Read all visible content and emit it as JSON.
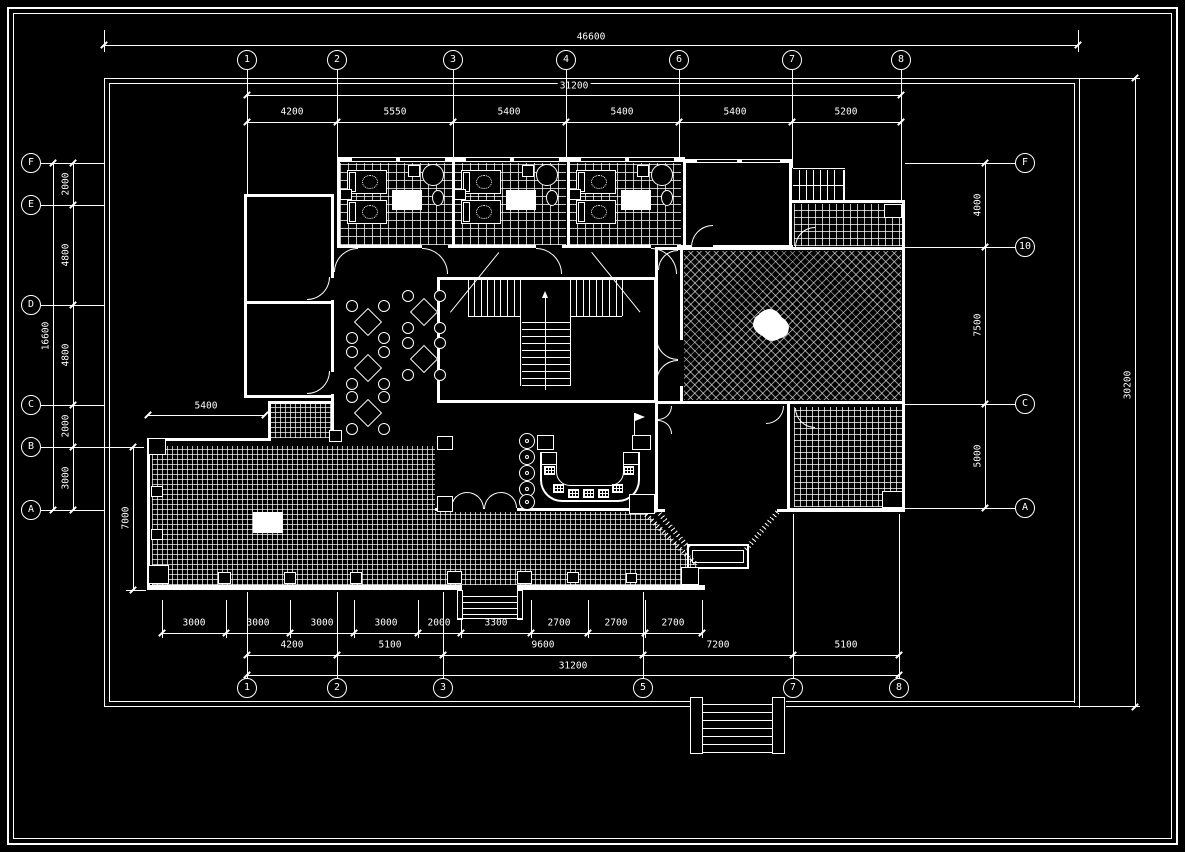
{
  "drawing": {
    "type": "architectural-floor-plan",
    "colors": {
      "background": "#000000",
      "line": "#ffffff"
    },
    "grid_bubbles": {
      "top": [
        "1",
        "2",
        "3",
        "4",
        "6",
        "7",
        "8"
      ],
      "bottom": [
        "1",
        "2",
        "3",
        "5",
        "7",
        "8"
      ],
      "left": [
        "F",
        "E",
        "D",
        "C",
        "B",
        "A"
      ],
      "right": [
        "F",
        "10",
        "C",
        "A"
      ]
    },
    "dimensions": {
      "top_overall": "46600",
      "top_total": "31200",
      "top_segments": [
        "4200",
        "5550",
        "5400",
        "5400",
        "5400",
        "5200"
      ],
      "bottom_segments_small": [
        "3000",
        "3000",
        "3000",
        "3000",
        "2000",
        "3300",
        "2700",
        "2700",
        "2700"
      ],
      "bottom_segments_mid": [
        "4200",
        "5100",
        "9600",
        "7200",
        "5100"
      ],
      "bottom_total": "31200",
      "left_segments": [
        "2000",
        "4800",
        "4800",
        "2000",
        "3000"
      ],
      "left_total": "16600",
      "left_wing_depth": "7000",
      "wing_width": "5400",
      "right_segments": [
        "4000",
        "7500",
        "5000"
      ],
      "right_total": "30200"
    }
  }
}
